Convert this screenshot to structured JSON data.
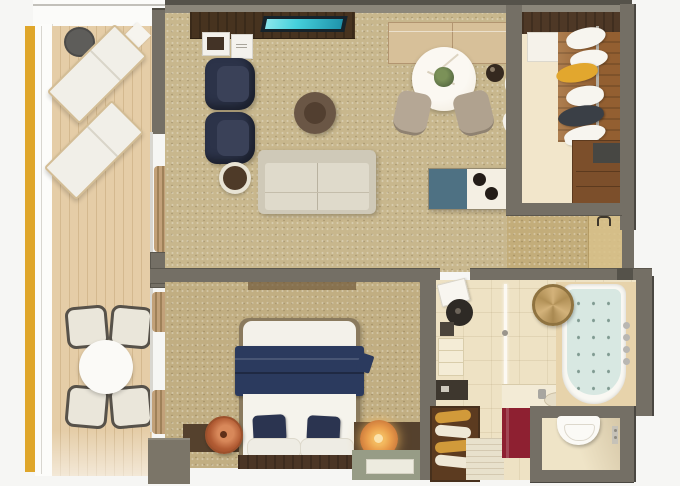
{
  "scene": {
    "type": "floor-plan-3d-render",
    "description": "Top-down 3D rendered floor plan of a suite: balcony with loungers and dining set, living room with sofa and TV console, dining table, walk-in closet, bedroom with double bed, and bathroom with tub, shower and separate toilet",
    "visible_text": ""
  },
  "colors": {
    "background": "#f6f6f4",
    "wall": "#746f65",
    "wallDark": "#55524a",
    "wallLight": "#8b867a",
    "carpetLiving": "#c8b78d",
    "carpetBedroom": "#c1ae82",
    "deck": "#e5cda7",
    "deckLine": "#d4b98f",
    "goldStrip": "#dfa62a",
    "sofa": "#dfdacb",
    "sofaFrame": "#cfc9b8",
    "armchair": "#2c3349",
    "tvWood": "#47331f",
    "tvScreen": "#45cfdc",
    "ottoman": "#6a5645",
    "marble": "#f6f2e9",
    "plant": "#5c7045",
    "sideboard": "#d7c099",
    "barTeal": "#4e7183",
    "blanket": "#2b3a5e",
    "pillowNavy": "#2b3450",
    "sheet": "#f5f3ec",
    "headboard": "#4c3626",
    "nightstand": "#55412d",
    "lamp": "#b15b33",
    "lampGlow": "#f3b95f",
    "bathFloor": "#eee2c4",
    "tubWater": "#d8e8e2",
    "redCabinet": "#8e2031",
    "towelGold": "#d19a3a",
    "towelWhite": "#efe8d6",
    "woodFloor": "#935f31",
    "closetFloor": "#f2e6cb",
    "shelfWood": "#4e3826",
    "yellowGarment": "#e2a72e",
    "jacket": "#3a3f46",
    "basket": "#c8a76a",
    "door": "#d9c28b",
    "curtain": "#c2a179",
    "curtainDark": "#9f8159",
    "oliveDesk": "#979c86",
    "wicker": "#57524a",
    "cushion": "#eae6da",
    "white": "#f7f5ef"
  },
  "objects": {
    "balcony": [
      "sun-lounger",
      "sun-lounger",
      "side-table",
      "dining-table-round",
      "wicker-chair",
      "wicker-chair",
      "wicker-chair",
      "wicker-chair"
    ],
    "living_room": [
      "tv-console",
      "flat-tv",
      "picture-tray",
      "guest-card",
      "armchair",
      "armchair",
      "ottoman",
      "sofa",
      "side-table",
      "sideboard",
      "ice-bucket",
      "wall-sconce",
      "wall-sconce",
      "dining-table-marble",
      "dining-chair",
      "dining-chair",
      "minibar-cabinet",
      "entrance-door"
    ],
    "closet": [
      "top-shelf",
      "cabinet",
      "clothes-rail",
      "hanging-clothes",
      "dresser"
    ],
    "bedroom": [
      "double-bed",
      "navy-blanket",
      "navy-cushion",
      "navy-cushion",
      "pillow",
      "pillow",
      "headboard",
      "nightstand",
      "nightstand",
      "table-lamp",
      "table-lamp-glowing",
      "desk",
      "tray",
      "curtains"
    ],
    "bathroom": [
      "bathroom-door",
      "round-basin",
      "shelf-niche",
      "vanity-counter",
      "faucet",
      "red-vanity-cabinet",
      "shower-glass",
      "shower-floor",
      "towel-shelf",
      "bathtub",
      "tub-fixtures",
      "woven-basket",
      "toilet",
      "flush-plate"
    ]
  }
}
